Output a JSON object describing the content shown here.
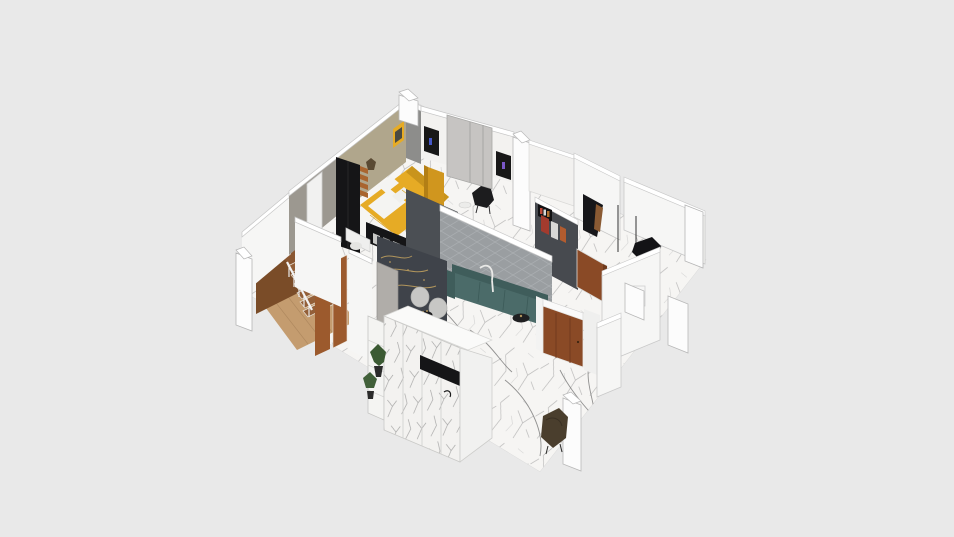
{
  "canvas": {
    "background": "#e9e9e9",
    "description": "3D isometric cutaway floor plan render of an apartment with bedroom, living-dining room, stair hall, entry and side rooms"
  },
  "rooms": [
    "bedroom",
    "stair-hall",
    "living-dining-room",
    "kitchen-bar",
    "entry",
    "hallway",
    "right-room-top",
    "right-room-bottom"
  ],
  "objects": [
    "yellow-double-bed",
    "black-wardrobe",
    "tv-panels",
    "sliding-closet-panel",
    "wood-staircase",
    "teal-sofa",
    "round-coffee-table",
    "dining-chairs",
    "gold-calligraphy-wall",
    "diamond-padded-wall",
    "marble-cabinet",
    "entry-door",
    "potted-plants",
    "accent-armchairs"
  ],
  "colors": {
    "floorMarble": "#f6f5f3",
    "marbleVein": "#a0a0a0",
    "marbleVeinDark": "#6f6f6f",
    "wallWhite": "#f6f6f5",
    "wallWhiteDim": "#efefee",
    "wallTop": "#ffffff",
    "wallOutline": "#c3c3c3",
    "wallOlive": "#b0a68c",
    "wallOliveShade": "#9c9890",
    "wallHeadboardGray": "#8d8d8b",
    "wallTexturedGray": "#9a9ea1",
    "texturedLine": "#a9adb0",
    "wallCornerDark": "#4b4f54",
    "wallNavy": "#3f434a",
    "wallArtDark": "#474a4f",
    "goldAccent": "#b1955c",
    "woodFloor": "#c49c6f",
    "woodPlankLine": "#ab855c",
    "stairWood": "#935f38",
    "stairWall": "#7a4c28",
    "stairLanding": "#8a5732",
    "doorBrown": "#8a4a26",
    "doorBrownDark": "#6f3a1d",
    "panelBrown": "#9c5a2d",
    "doorGray": "#b0ada9",
    "panelGray": "#c6c4c2",
    "bedYellow": "#e6ab25",
    "bedYellowShade": "#c9941c",
    "benchYellow": "#d0961e",
    "benchYellowSide": "#b37f15",
    "beddingWhite": "#f4f4f2",
    "furnitureBlack": "#151517",
    "tvBlack": "#181818",
    "tvGlowBlue": "#4658c8",
    "tvGlowPurple": "#7a58c8",
    "shelfOrange": "#a9652f",
    "sofaTeal": "#4b6b69",
    "sofaTealDark": "#3f5d5b",
    "chairGray": "#c7c7c5",
    "tableWhite": "#d9d9d7",
    "tableShadow": "#e3e3e1",
    "artRed": "#a33b2e",
    "artWhite": "#d8d8d6",
    "artOrange": "#b25c2f",
    "plantGreen": "#3b5a33",
    "plantGreenDark": "#41603a",
    "potBlack": "#2b2b2b",
    "chairOliveDark": "#4a3e2d",
    "columnWhite": "#fcfcfc"
  }
}
